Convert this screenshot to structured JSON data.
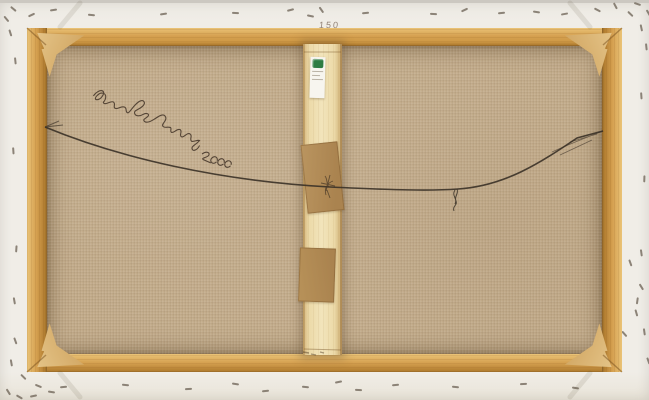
{
  "scene": {
    "description": "Reverse side of a stretched canvas artwork: wooden stretcher frame with corner keys, stapled white canvas fold, central wooden brace with inventory sticker and two kraft-tape patches, sagging hanging wire, cursive artist signature at upper left, and size notation at top center",
    "size_label": "150",
    "signature": {
      "legible": false,
      "style": "cursive ink, sloping down to the right"
    },
    "inventory_label": {
      "mark_color": "green",
      "text_legible": false
    }
  },
  "colors": {
    "bg-border": "#f0ede7",
    "top-strip": "#ccc8c1",
    "frame-light": "#eac377",
    "frame-mid": "#d5a050",
    "frame-dark": "#b07c2f",
    "frame-edge": "#8a6228",
    "canvas": "#c2ab8a",
    "brace": "#ecdaa9",
    "wedge": "#d2a763",
    "tape": "#aa834f",
    "label-bg": "#f7f5ef",
    "label-green": "#2e7d43",
    "wire": "#3a3127",
    "ink": "#46372a",
    "staple": "#6f6558",
    "size-label-color": "#86766a"
  },
  "staples": [
    [
      88,
      14,
      5
    ],
    [
      160,
      13,
      -8
    ],
    [
      232,
      12,
      3
    ],
    [
      287,
      9,
      -15
    ],
    [
      307,
      15,
      12
    ],
    [
      318,
      9,
      55
    ],
    [
      362,
      12,
      -5
    ],
    [
      430,
      13,
      4
    ],
    [
      461,
      9,
      -25
    ],
    [
      498,
      12,
      -6
    ],
    [
      533,
      11,
      8
    ],
    [
      561,
      13,
      -10
    ],
    [
      594,
      9,
      28
    ],
    [
      612,
      5,
      62
    ],
    [
      627,
      13,
      44
    ],
    [
      638,
      27,
      78
    ],
    [
      634,
      3,
      18
    ],
    [
      643,
      46,
      84
    ],
    [
      645,
      12,
      60
    ],
    [
      638,
      95,
      86
    ],
    [
      641,
      178,
      92
    ],
    [
      638,
      252,
      82
    ],
    [
      634,
      300,
      98
    ],
    [
      627,
      262,
      70
    ],
    [
      638,
      286,
      58
    ],
    [
      633,
      312,
      74
    ],
    [
      621,
      333,
      48
    ],
    [
      611,
      352,
      38
    ],
    [
      641,
      331,
      82
    ],
    [
      645,
      360,
      70
    ],
    [
      60,
      386,
      -5
    ],
    [
      122,
      384,
      6
    ],
    [
      185,
      388,
      -4
    ],
    [
      232,
      383,
      8
    ],
    [
      262,
      390,
      -6
    ],
    [
      302,
      386,
      5
    ],
    [
      335,
      381,
      -12
    ],
    [
      355,
      389,
      4
    ],
    [
      392,
      384,
      -5
    ],
    [
      452,
      386,
      6
    ],
    [
      520,
      383,
      -4
    ],
    [
      572,
      387,
      8
    ],
    [
      12,
      340,
      70
    ],
    [
      8,
      362,
      80
    ],
    [
      20,
      376,
      45
    ],
    [
      35,
      385,
      22
    ],
    [
      48,
      391,
      8
    ],
    [
      30,
      395,
      -12
    ],
    [
      5,
      391,
      58
    ],
    [
      16,
      396,
      30
    ],
    [
      10,
      150,
      86
    ],
    [
      13,
      248,
      94
    ],
    [
      11,
      300,
      80
    ],
    [
      10,
      8,
      40
    ],
    [
      28,
      14,
      -25
    ],
    [
      50,
      9,
      -8
    ],
    [
      7,
      32,
      72
    ],
    [
      12,
      60,
      84
    ],
    [
      3,
      18,
      50
    ]
  ]
}
